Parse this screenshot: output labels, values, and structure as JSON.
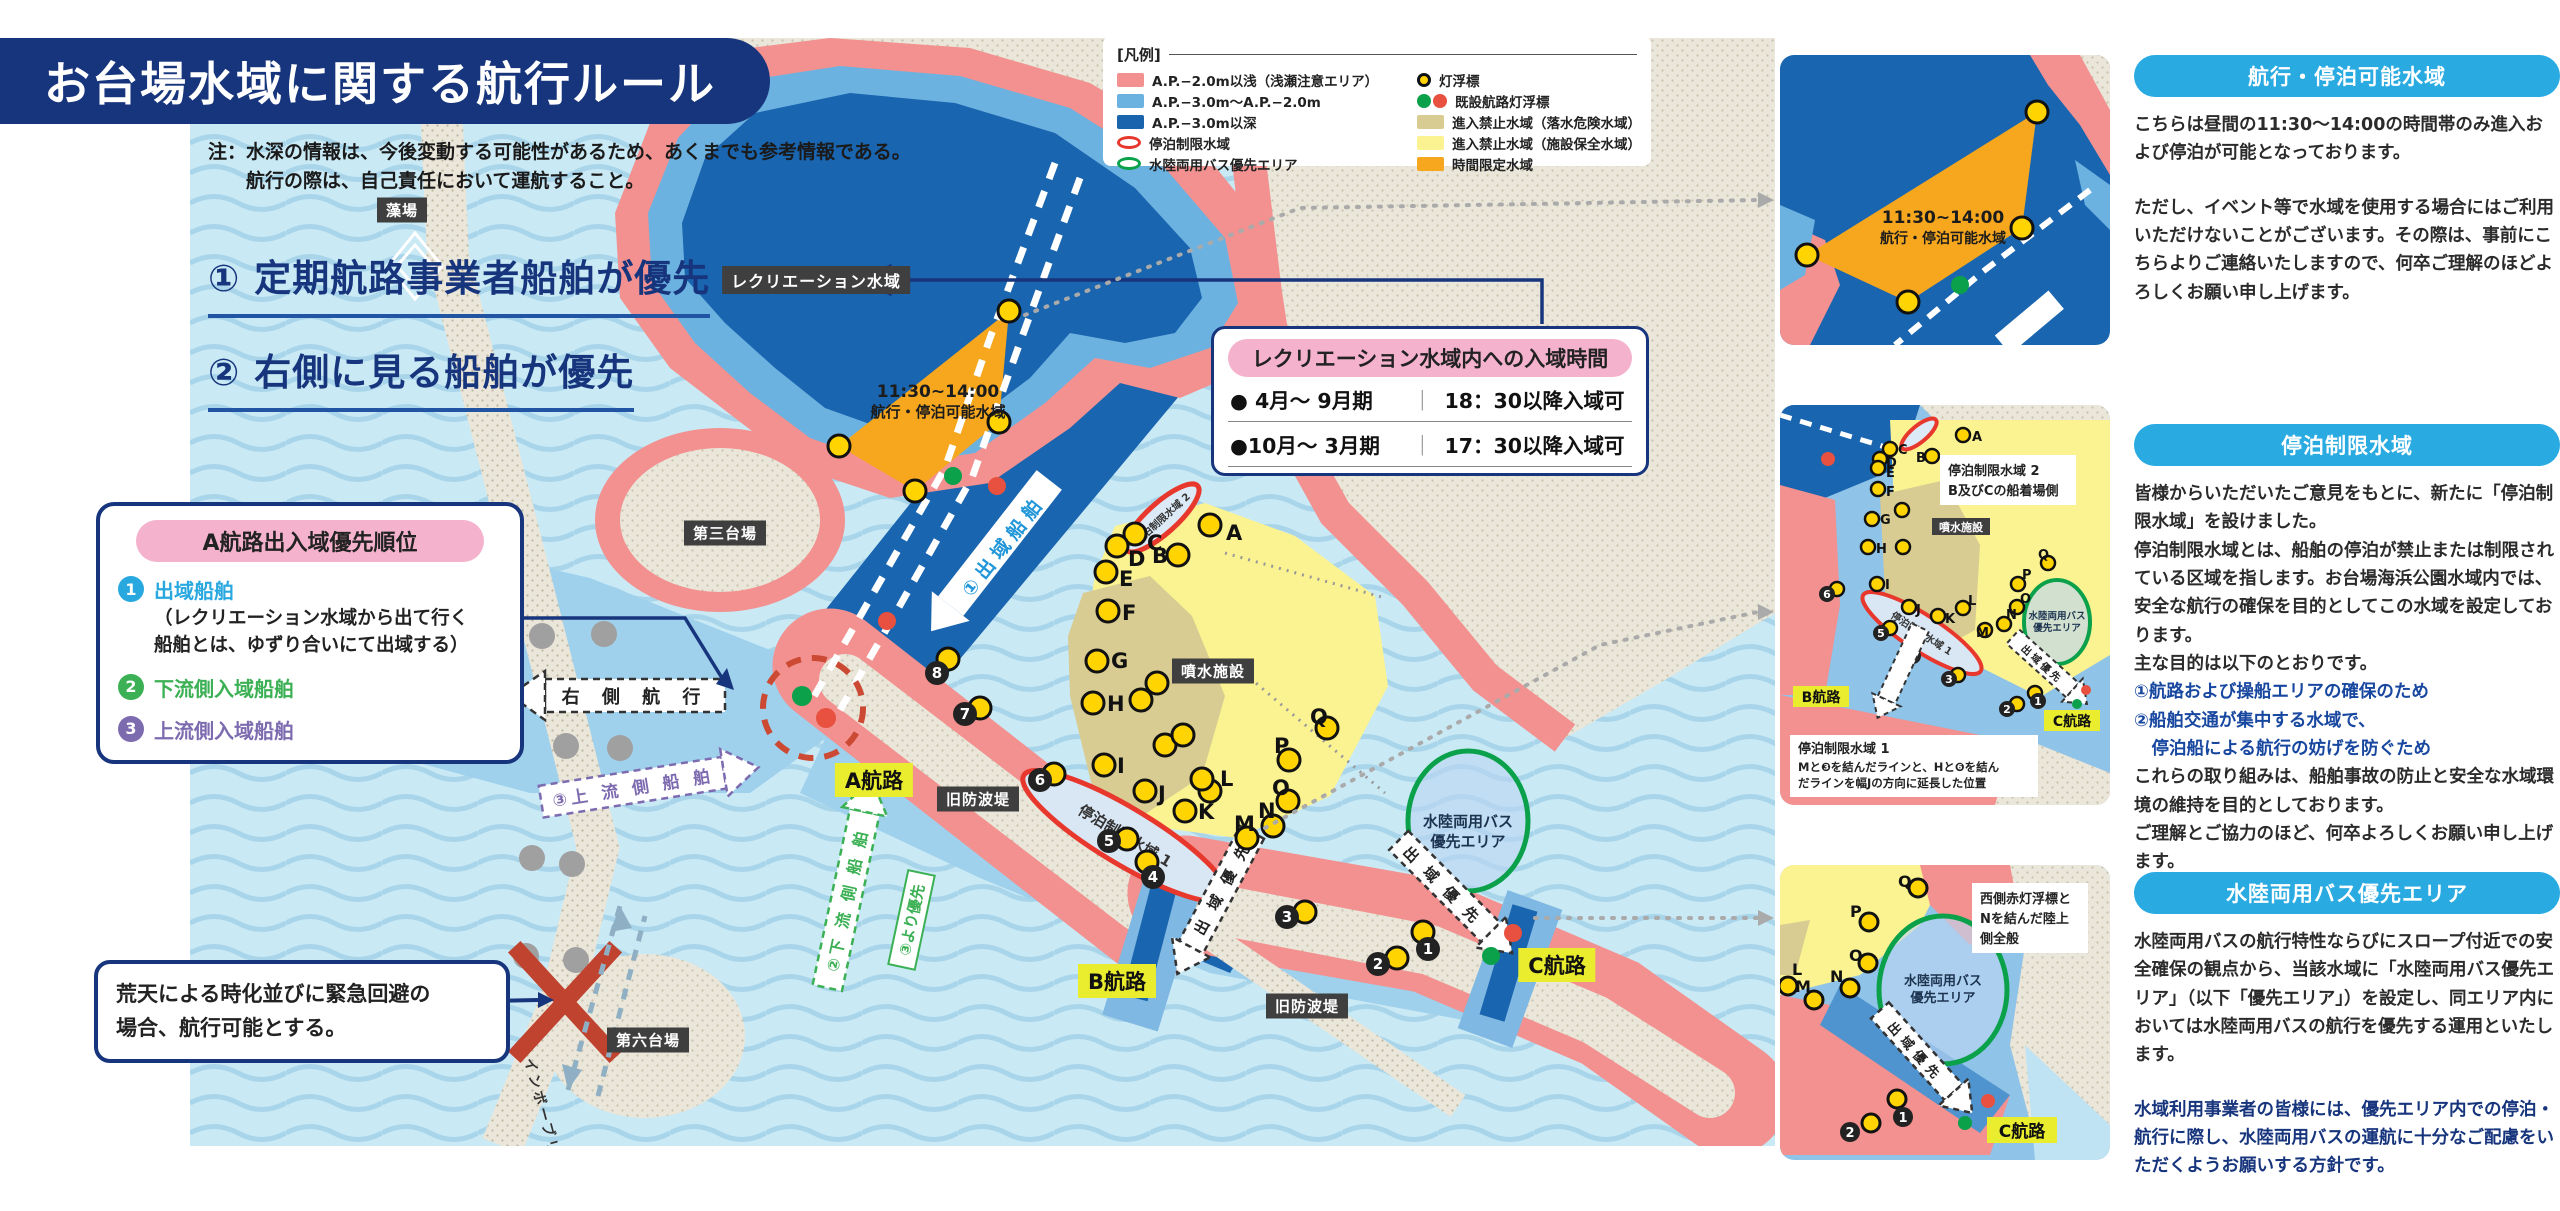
{
  "title": "お台場水域に関する航行ルール",
  "note": {
    "line1": "注：水深の情報は、今後変動する可能性があるため、あくまでも参考情報である。",
    "line2": "航行の際は、自己責任において運航すること。"
  },
  "rules": {
    "rule1": "① 定期航路事業者船舶が優先",
    "rule2": "② 右側に見る船舶が優先"
  },
  "priority_box": {
    "title": "A航路出入域優先順位",
    "items": [
      {
        "num": "1",
        "label": "出域船舶",
        "note1": "（レクリエーション水域から出て行く",
        "note2": "船舶とは、ゆずり合いにて出域する）"
      },
      {
        "num": "2",
        "label": "下流側入域船舶"
      },
      {
        "num": "3",
        "label": "上流側入域船舶"
      }
    ]
  },
  "storm_box": {
    "line1": "荒天による時化並びに緊急回避の",
    "line2": "場合、航行可能とする。"
  },
  "legend": {
    "title": "[凡例]",
    "col1": [
      {
        "swatch": "pink-rect",
        "label": "A.P.−2.0m以浅（浅瀬注意エリア）"
      },
      {
        "swatch": "lightblue-rect",
        "label": "A.P.−3.0m〜A.P.−2.0m"
      },
      {
        "swatch": "darkblue-rect",
        "label": "A.P.−3.0m以深"
      },
      {
        "swatch": "red-ellipse",
        "label": "停泊制限水域"
      },
      {
        "swatch": "green-ellipse",
        "label": "水陸両用バス優先エリア"
      }
    ],
    "col2": [
      {
        "swatch": "yellow-buoy",
        "label": "灯浮標"
      },
      {
        "swatch": "green-red-buoys",
        "label": "既設航路灯浮標"
      },
      {
        "swatch": "khaki-rect",
        "label": "進入禁止水域（落水危険水域）"
      },
      {
        "swatch": "yellow-rect",
        "label": "進入禁止水域（施設保全水域）"
      },
      {
        "swatch": "orange-rect",
        "label": "時間限定水域"
      }
    ]
  },
  "entry_time_box": {
    "title": "レクリエーション水域内への入域時間",
    "rows": [
      {
        "period": "● 4月〜 9月期",
        "time": "18：30以降入域可"
      },
      {
        "period": "●10月〜 3月期",
        "time": "17：30以降入域可"
      }
    ]
  },
  "map": {
    "recreation_label": "レクリエーション水域",
    "moba": "藻場",
    "daiba3": "第三台場",
    "daiba6": "第六台場",
    "fountain": "噴水施設",
    "old_breakwater1": "旧防波堤",
    "old_breakwater2": "旧防波堤",
    "route_a": "A航路",
    "route_b": "B航路",
    "route_c": "C航路",
    "rainbow_bridge": "レインボーブリッジ",
    "time_area_line1": "11:30~14:00",
    "time_area_line2": "航行・停泊可能水域",
    "teihaku1": "停泊制限水域 1",
    "teihaku2": "停泊制限水域 2",
    "amphibious_line1": "水陸両用バス",
    "amphibious_line2": "優先エリア",
    "arrow_outbound": "①出域船舶",
    "arrow_right_side": "右 側 航 行",
    "arrow_upstream": "③上 流 側 船 舶",
    "arrow_downstream": "②下 流 側 船 舶",
    "arrow_priority_tag": "③より優先",
    "arrow_exit_priority_b": "出 域 優 先",
    "arrow_exit_priority_c": "出 域 優 先",
    "letter_buoys": [
      "A",
      "B",
      "C",
      "D",
      "E",
      "F",
      "G",
      "H",
      "I",
      "J",
      "K",
      "L",
      "M",
      "N",
      "O",
      "P",
      "Q"
    ],
    "number_buoys": [
      "1",
      "2",
      "3",
      "4",
      "5",
      "6",
      "7",
      "8"
    ]
  },
  "insets": {
    "inset1": {
      "label_line1": "11:30~14:00",
      "label_line2": "航行・停泊可能水域"
    },
    "inset2": {
      "note_top_line1": "停泊制限水域 2",
      "note_top_line2": "B及びCの船着場側",
      "fountain": "噴水施設",
      "ellipse_label": "停泊制限水域 1",
      "amphibious_line1": "水陸両用バス",
      "amphibious_line2": "優先エリア",
      "route_b": "B航路",
      "route_c": "C航路",
      "exit_priority": "出域優先",
      "note_bottom_title": "停泊制限水域 1",
      "note_bottom_line1": "Mと❸を結んだラインと、Hと❻を結ん",
      "note_bottom_line2": "だラインを幅Jの方向に延長した位置"
    },
    "inset3": {
      "note_line1": "西側赤灯浮標と",
      "note_line2": "Nを結んだ陸上",
      "note_line3": "側全般",
      "amphibious_line1": "水陸両用バス",
      "amphibious_line2": "優先エリア",
      "route_c": "C航路",
      "exit_priority": "出域優先"
    }
  },
  "panels": [
    {
      "title": "航行・停泊可能水域",
      "p1_pre": "こちらは昼間の",
      "p1_bold": "11:30〜14:00の時間帯のみ",
      "p1_post": "進入および停泊が可能となっております。",
      "p2": "ただし、イベント等で水域を使用する場合にはご利用いただけないことがございます。その際は、事前にこちらよりご連絡いたしますので、何卒ご理解のほどよろしくお願い申し上げます。"
    },
    {
      "title": "停泊制限水域",
      "p1": "皆様からいただいたご意見をもとに、新たに「停泊制限水域」を設けました。",
      "p2": "停泊制限水域とは、船舶の停泊が禁止または制限されている区域を指します。お台場海浜公園水域内では、安全な航行の確保を目的としてこの水域を設定しております。",
      "p3": "主な目的は以下のとおりです。",
      "goal1": "①航路および操船エリアの確保のため",
      "goal2": "②船舶交通が集中する水域で、",
      "goal3": "　停泊船による航行の妨げを防ぐため",
      "p4": "これらの取り組みは、船舶事故の防止と安全な水域環境の維持を目的としております。",
      "p5": "ご理解とご協力のほど、何卒よろしくお願い申し上げます。"
    },
    {
      "title": "水陸両用バス優先エリア",
      "p1": "水陸両用バスの航行特性ならびにスロープ付近での安全確保の観点から、当該水域に「水陸両用バス優先エリア」（以下「優先エリア」）を設定し、同エリア内においては水陸両用バスの航行を優先する運用といたします。",
      "p2": "水域利用事業者の皆様には、優先エリア内での停泊・航行に際し、水陸両用バスの運航に十分なご配慮をいただくようお願いする方針です。"
    }
  ],
  "colors": {
    "navy": "#17357d",
    "header_blue": "#29abe2",
    "shallow_pink": "#f2918f",
    "mid_blue": "#6cb2e1",
    "deep_blue": "#1a63ad",
    "restricted_khaki": "#d8cc92",
    "restricted_yellow": "#fbf291",
    "time_limited_orange": "#f6a71e",
    "buoy_yellow": "#ffd400",
    "route_red": "#e8382d",
    "route_green": "#0aa14a",
    "label_yellow": "#e9ed2e"
  }
}
